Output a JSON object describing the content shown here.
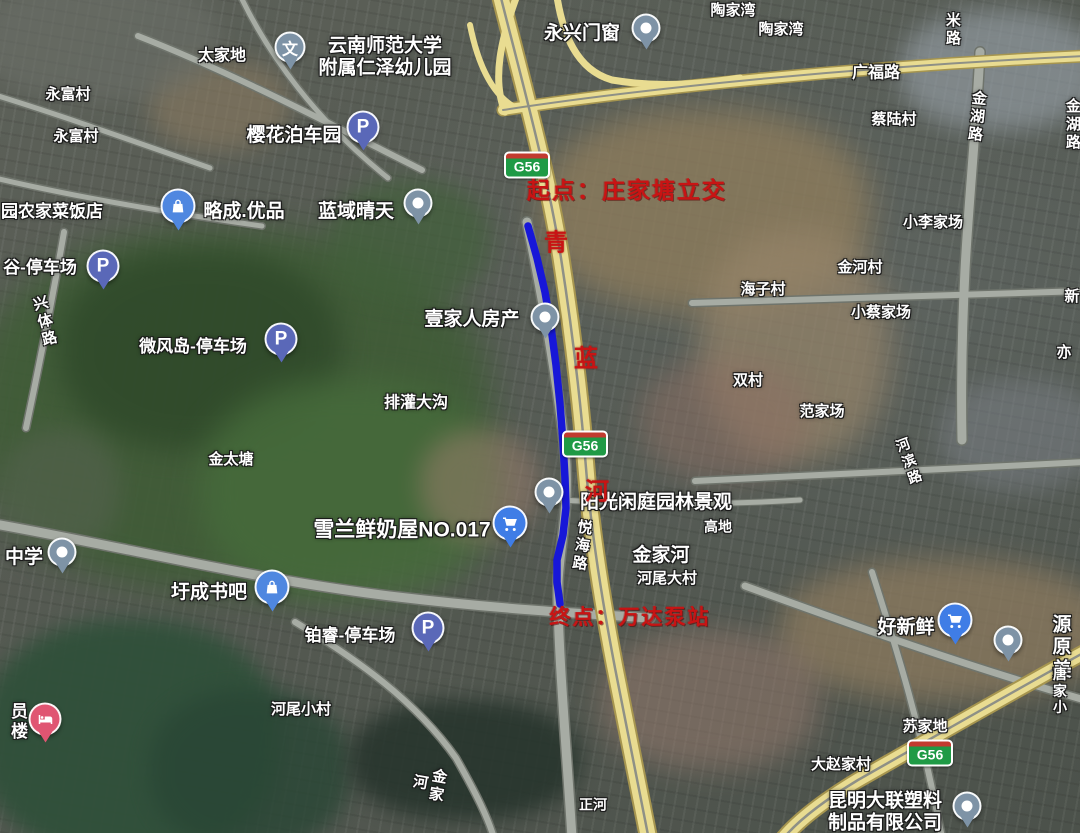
{
  "annotations": {
    "start": "起点：庄家塘立交",
    "end": "终点：万达泵站",
    "route_chars": [
      {
        "t": "青",
        "x": 556,
        "y": 240
      },
      {
        "t": "蓝",
        "x": 586,
        "y": 356
      },
      {
        "t": "河",
        "x": 597,
        "y": 489
      }
    ]
  },
  "badges": [
    {
      "label": "G56",
      "x": 527,
      "y": 165
    },
    {
      "label": "G56",
      "x": 585,
      "y": 444
    },
    {
      "label": "G56",
      "x": 930,
      "y": 753
    }
  ],
  "route": {
    "color": "#1717d8",
    "points": "528,226 537,258 545,292 551,327 556,365 560,404 563,443 565,478 566,508 563,535 557,560 557,582 560,604"
  },
  "colors": {
    "annotation_red": "#c81414",
    "expressway_fill": "#e9dc91",
    "road_gray": "#a7aca4",
    "badge_green": "#1f9a45",
    "badge_red": "#c23b2f"
  },
  "pin_colors": {
    "parking": "#5a68b8",
    "poi": "#7e93a6",
    "school": "#7e93a6",
    "bag": "#4f87e0",
    "cart": "#3f7de6",
    "bed": "#e05572"
  },
  "labels": [
    {
      "t": "太家地",
      "x": 222,
      "y": 57,
      "s": 16
    },
    {
      "t": "云南师范大学\n附属仁泽幼儿园",
      "x": 385,
      "y": 58,
      "s": 19
    },
    {
      "t": "永富村",
      "x": 68,
      "y": 95,
      "s": 15
    },
    {
      "t": "永富村",
      "x": 76,
      "y": 137,
      "s": 15
    },
    {
      "t": "樱花泊车园",
      "x": 294,
      "y": 136,
      "s": 19
    },
    {
      "t": "陶家湾",
      "x": 733,
      "y": 11,
      "s": 15
    },
    {
      "t": "陶家湾",
      "x": 781,
      "y": 30,
      "s": 15
    },
    {
      "t": "永兴门窗",
      "x": 582,
      "y": 34,
      "s": 19
    },
    {
      "t": "广福路",
      "x": 876,
      "y": 74,
      "s": 16
    },
    {
      "t": "蔡陆村",
      "x": 894,
      "y": 120,
      "s": 15
    },
    {
      "t": "小李家场",
      "x": 933,
      "y": 223,
      "s": 15
    },
    {
      "t": "金河村",
      "x": 860,
      "y": 268,
      "s": 15
    },
    {
      "t": "海子村",
      "x": 763,
      "y": 290,
      "s": 15
    },
    {
      "t": "小蔡家场",
      "x": 881,
      "y": 313,
      "s": 15
    },
    {
      "t": "双村",
      "x": 748,
      "y": 381,
      "s": 15
    },
    {
      "t": "范家场",
      "x": 822,
      "y": 412,
      "s": 15
    },
    {
      "t": "园农家菜饭店",
      "x": 52,
      "y": 212,
      "s": 17
    },
    {
      "t": "略成.优品",
      "x": 244,
      "y": 212,
      "s": 19
    },
    {
      "t": "蓝域晴天",
      "x": 356,
      "y": 212,
      "s": 19
    },
    {
      "t": "谷-停车场",
      "x": 40,
      "y": 268,
      "s": 17
    },
    {
      "t": "微风岛-停车场",
      "x": 193,
      "y": 347,
      "s": 17
    },
    {
      "t": "排灌大沟",
      "x": 416,
      "y": 404,
      "s": 16
    },
    {
      "t": "壹家人房产",
      "x": 472,
      "y": 320,
      "s": 19
    },
    {
      "t": "金太塘",
      "x": 231,
      "y": 460,
      "s": 15
    },
    {
      "t": "雪兰鲜奶屋NO.017",
      "x": 402,
      "y": 531,
      "s": 21
    },
    {
      "t": "阳光闲庭园林景观",
      "x": 656,
      "y": 503,
      "s": 19
    },
    {
      "t": "高地",
      "x": 718,
      "y": 527,
      "s": 14
    },
    {
      "t": "金家河",
      "x": 661,
      "y": 556,
      "s": 19
    },
    {
      "t": "河尾大村",
      "x": 667,
      "y": 579,
      "s": 15
    },
    {
      "t": "中学",
      "x": 24,
      "y": 558,
      "s": 19
    },
    {
      "t": "圩成书吧",
      "x": 209,
      "y": 593,
      "s": 19
    },
    {
      "t": "铂睿-停车场",
      "x": 350,
      "y": 636,
      "s": 17
    },
    {
      "t": "河尾小村",
      "x": 301,
      "y": 710,
      "s": 15
    },
    {
      "t": "好新鲜",
      "x": 906,
      "y": 628,
      "s": 19
    },
    {
      "t": "源原美",
      "x": 1062,
      "y": 648,
      "s": 19
    },
    {
      "t": "唐家小",
      "x": 1060,
      "y": 691,
      "s": 14
    },
    {
      "t": "苏家地",
      "x": 925,
      "y": 727,
      "s": 15
    },
    {
      "t": "大赵家村",
      "x": 841,
      "y": 765,
      "s": 15
    },
    {
      "t": "昆明大联塑料\n制品有限公司",
      "x": 885,
      "y": 813,
      "s": 19
    },
    {
      "t": "正河",
      "x": 593,
      "y": 805,
      "s": 14
    },
    {
      "t": "员楼",
      "x": 17,
      "y": 722,
      "s": 17,
      "v": 1
    },
    {
      "t": "米路",
      "x": 952,
      "y": 30,
      "s": 15,
      "v": 1
    },
    {
      "t": "金湖路",
      "x": 976,
      "y": 117,
      "s": 15,
      "v": 1,
      "rot": 6
    },
    {
      "t": "金湖路",
      "x": 1072,
      "y": 125,
      "s": 15,
      "v": 1
    },
    {
      "t": "兴体路",
      "x": 44,
      "y": 322,
      "s": 15,
      "v": 1,
      "rot": -14
    },
    {
      "t": "悦海路",
      "x": 581,
      "y": 546,
      "s": 15,
      "v": 1,
      "rot": 8
    },
    {
      "t": "金家河",
      "x": 428,
      "y": 784,
      "s": 15,
      "v": 1,
      "rot": 10
    },
    {
      "t": "河滨路",
      "x": 909,
      "y": 462,
      "s": 14,
      "v": 1,
      "rot": -20
    },
    {
      "t": "新",
      "x": 1072,
      "y": 297,
      "s": 15
    },
    {
      "t": "亦",
      "x": 1064,
      "y": 353,
      "s": 15
    }
  ],
  "pins": [
    {
      "type": "school",
      "x": 290,
      "y": 47
    },
    {
      "type": "parking",
      "x": 363,
      "y": 127
    },
    {
      "type": "poi",
      "x": 646,
      "y": 28
    },
    {
      "type": "bag",
      "x": 178,
      "y": 206
    },
    {
      "type": "poi",
      "x": 418,
      "y": 203
    },
    {
      "type": "parking",
      "x": 103,
      "y": 266
    },
    {
      "type": "parking",
      "x": 281,
      "y": 339
    },
    {
      "type": "poi",
      "x": 545,
      "y": 317
    },
    {
      "type": "cart",
      "x": 510,
      "y": 523
    },
    {
      "type": "poi",
      "x": 549,
      "y": 492
    },
    {
      "type": "poi",
      "x": 62,
      "y": 552
    },
    {
      "type": "bag",
      "x": 272,
      "y": 587
    },
    {
      "type": "parking",
      "x": 428,
      "y": 628
    },
    {
      "type": "bed",
      "x": 45,
      "y": 719
    },
    {
      "type": "cart",
      "x": 955,
      "y": 620
    },
    {
      "type": "poi",
      "x": 1008,
      "y": 640
    },
    {
      "type": "poi",
      "x": 967,
      "y": 806
    }
  ]
}
